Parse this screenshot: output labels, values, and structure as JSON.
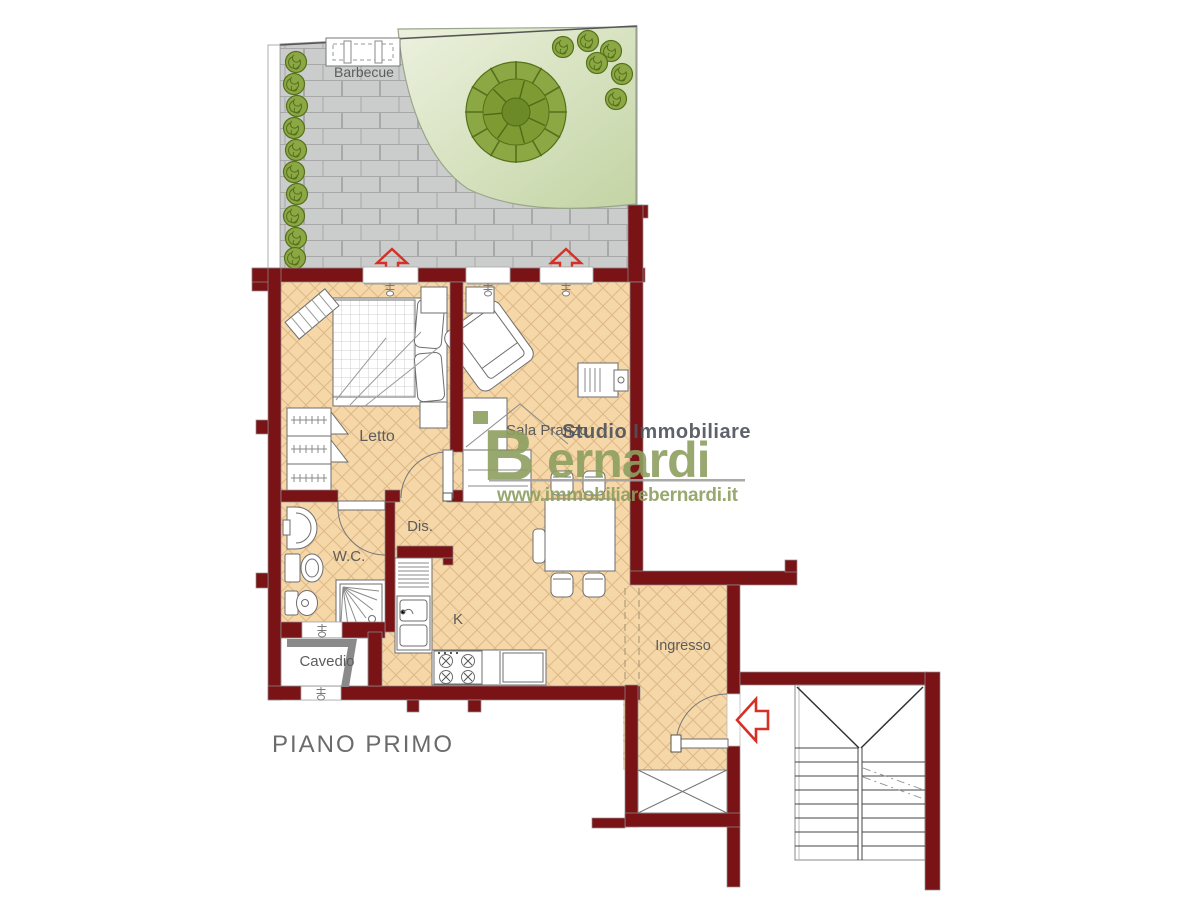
{
  "plan": {
    "floor_title": "PIANO PRIMO",
    "room_labels": {
      "barbecue": "Barbecue",
      "letto": "Letto",
      "sala_pranzo": "Sala Pranzo",
      "dis": "Dis.",
      "wc": "W.C.",
      "kitchen": "K",
      "ingresso": "Ingresso",
      "cavedio": "Cavedio"
    }
  },
  "watermark": {
    "studio_line": "Studio Immobiliare",
    "brand_initial": "B",
    "brand_rest": "ernardi",
    "website": "www.immobiliarebernardi.it"
  },
  "colors": {
    "wall": "#7a1315",
    "floor": "#f5d7a8",
    "floor_line": "#dfb988",
    "paving": "#cbcccc",
    "paving_line": "#a8a8a8",
    "lawn_light": "#ecf1de",
    "lawn_dark": "#c3d4a4",
    "bush": "#8CA845",
    "bush_dark": "#55711b",
    "arrow_red": "#d63026",
    "furniture_stroke": "#6e6e6e",
    "label_gray": "#5c5c5c",
    "watermark_green": "#8d9f60",
    "watermark_gray": "#4d525a"
  }
}
